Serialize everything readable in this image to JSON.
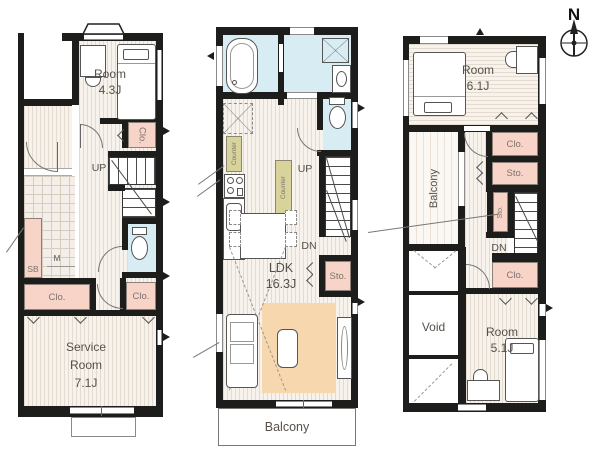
{
  "compass": {
    "north": "N"
  },
  "colors": {
    "wall": "#1d1d1b",
    "floor_stripe": "#e3dad0",
    "closet_pink": "#f8d3c8",
    "wet_area_blue": "#d8ecf4",
    "counter_olive": "#d8d29b",
    "rug_orange": "#f7d8ae"
  },
  "floor1": {
    "room": {
      "line1": "Room",
      "line2": "4.3J"
    },
    "closet_right": "Clo.",
    "stairs_up": "UP",
    "shoe_box": "SB",
    "meter": "M",
    "closet_left": "Clo.",
    "closet_hall": "Clo.",
    "service_room": {
      "line1": "Service",
      "line2": "Room",
      "line3": "7.1J"
    }
  },
  "floor2": {
    "counter_left": "Counter",
    "counter_island": "Counter",
    "stairs_up": "UP",
    "stairs_down": "DN",
    "storage": "Sto.",
    "ldk": {
      "line1": "LDK",
      "line2": "16.3J"
    },
    "balcony": "Balcony"
  },
  "floor3": {
    "room_upper": {
      "line1": "Room",
      "line2": "6.1J"
    },
    "balcony": "Balcony",
    "closet_upper": "Clo.",
    "storage_upper": "Sto.",
    "storage_small": "Sto.",
    "stairs_down": "DN",
    "closet_lower": "Clo.",
    "void": "Void",
    "room_lower": {
      "line1": "Room",
      "line2": "5.1J"
    }
  }
}
